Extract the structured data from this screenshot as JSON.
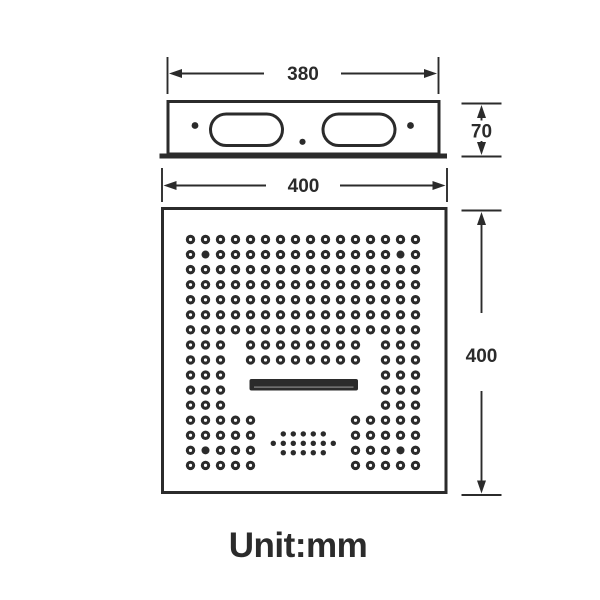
{
  "ink_color": "#2b2b2b",
  "background_color": "#ffffff",
  "unit_label": "Unit:mm",
  "dimensions": {
    "top_width": "380",
    "body_height": "70",
    "face_width": "400",
    "face_height": "400"
  },
  "nozzle_grid": {
    "origin_x": 190.5,
    "origin_y": 239.5,
    "spacing_x": 15.0,
    "spacing_y": 15.06,
    "outer_radius": 4.7,
    "hole_radius": 1.6,
    "solid_radius": 4.0,
    "row_columns": [
      "1-16",
      "1-16",
      "1-16",
      "1-16",
      "1-16",
      "1-16",
      "1-16",
      "1-3,5-12,14-16",
      "1-3,5-12,14-16",
      "1-3,14-16",
      "1-3,14-16",
      "1-3,14-16",
      "1-5,12-16",
      "1-5,12-16",
      "1-5,12-16",
      "1-5,12-16"
    ],
    "solid_dots": [
      [
        2,
        2
      ],
      [
        15,
        2
      ],
      [
        2,
        15
      ],
      [
        15,
        15
      ]
    ]
  },
  "mist_cluster": {
    "center_x": 303.3,
    "center_y": 443.3,
    "spacing_x": 10,
    "spacing_y": 9.4,
    "dot_radius": 2.7,
    "row_counts": [
      5,
      7,
      5
    ]
  }
}
